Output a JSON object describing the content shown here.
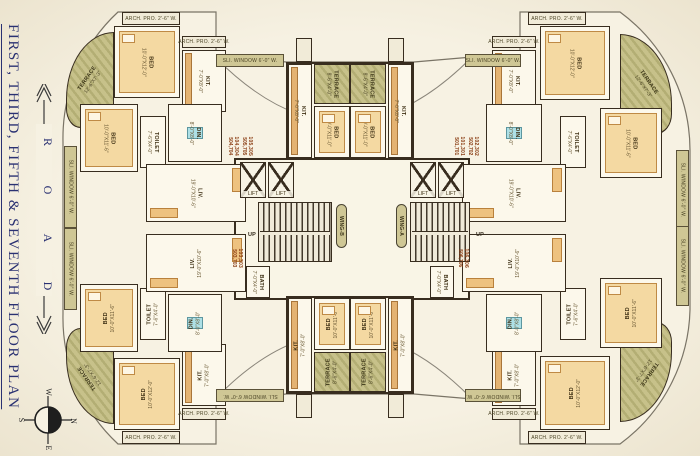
{
  "sidebar": {
    "title": "FIRST, THIRD, FIFTH & SEVENTH FLOOR PLAN",
    "road": {
      "letters": [
        "R",
        "O",
        "A",
        "D"
      ]
    },
    "compass": {
      "w": "W",
      "n": "N",
      "s": "S",
      "e": "E"
    }
  },
  "plan": {
    "accent_colors": {
      "wall": "#382d1f",
      "terrace": "#b3ae74",
      "window_strip": "#cfc795",
      "flat_number": "#8a3c12",
      "title_navy": "#2a3172"
    },
    "items": [
      {
        "n": "core-hall",
        "t": "core",
        "x": 234,
        "y": 158,
        "w": 236,
        "h": 142
      },
      {
        "n": "core-top-block",
        "t": "core",
        "x": 286,
        "y": 62,
        "w": 128,
        "h": 98
      },
      {
        "n": "core-bottom-block",
        "t": "core",
        "x": 286,
        "y": 296,
        "w": 128,
        "h": 98
      },
      {
        "n": "terrace-tl",
        "t": "terrace",
        "x": 66,
        "y": 32,
        "w": 48,
        "h": 96,
        "r": -55,
        "l": "TERRACE",
        "d": "12'-6\"X7'-3\"",
        "br": "100% 0 0 30% / 70% 0 0 20%"
      },
      {
        "n": "archpro-tl",
        "t": "box",
        "x": 122,
        "y": 12,
        "w": 58,
        "h": 13,
        "l": "ARCH. PRO. 2'-6\" W."
      },
      {
        "n": "bed1-tl",
        "t": "room",
        "x": 114,
        "y": 26,
        "w": 66,
        "h": 72,
        "r": 90,
        "l": "BED",
        "d": "10'-0\"X12'-0\"",
        "f": "bed"
      },
      {
        "n": "archpro2-tl",
        "t": "box",
        "x": 182,
        "y": 36,
        "w": 44,
        "h": 12,
        "l": "ARCH. PRO. 2'-6\" W."
      },
      {
        "n": "kit-tl",
        "t": "room",
        "x": 182,
        "y": 50,
        "w": 44,
        "h": 62,
        "r": 90,
        "l": "KIT.",
        "d": "7'-0\"X8'-0\"",
        "f": "counter"
      },
      {
        "n": "bed2-tl",
        "t": "room",
        "x": 80,
        "y": 104,
        "w": 58,
        "h": 68,
        "r": 90,
        "l": "BED",
        "d": "10'-0\"X11'-6\"",
        "f": "bed"
      },
      {
        "n": "sliwindow-tl",
        "t": "strip",
        "x": 64,
        "y": 146,
        "w": 13,
        "h": 82,
        "r": 90,
        "l": "SLI. WINDOW 6'-0\" W."
      },
      {
        "n": "toilet-tl",
        "t": "room",
        "x": 140,
        "y": 116,
        "w": 26,
        "h": 52,
        "r": 90,
        "l": "TOILET",
        "d": "7'-6\"X4'-0\""
      },
      {
        "n": "din-tl",
        "t": "room",
        "x": 168,
        "y": 104,
        "w": 54,
        "h": 58,
        "r": 90,
        "l": "DIN.",
        "d": "8'-0\"X8'-0\"",
        "f": "table"
      },
      {
        "n": "liv-tl",
        "t": "room",
        "x": 146,
        "y": 164,
        "w": 100,
        "h": 58,
        "r": 90,
        "l": "LIV.",
        "d": "19'-0\"X10'-6\"",
        "f": "sofa"
      },
      {
        "n": "terrace-bl",
        "t": "terrace",
        "x": 66,
        "y": 328,
        "w": 48,
        "h": 96,
        "r": 235,
        "l": "TERRACE",
        "d": "12'-6\"X7'-3\"",
        "br": "30% 0 0 100% / 20% 0 0 70%"
      },
      {
        "n": "archpro-bl",
        "t": "box",
        "x": 122,
        "y": 431,
        "w": 58,
        "h": 13,
        "l": "ARCH. PRO. 2'-6\" W."
      },
      {
        "n": "bed1-bl",
        "t": "room",
        "x": 114,
        "y": 358,
        "w": 66,
        "h": 72,
        "r": -90,
        "l": "BED",
        "d": "10'-0\"X12'-0\"",
        "f": "bed"
      },
      {
        "n": "archpro2-bl",
        "t": "box",
        "x": 182,
        "y": 408,
        "w": 44,
        "h": 12,
        "l": "ARCH. PRO. 2'-6\" W."
      },
      {
        "n": "kit-bl",
        "t": "room",
        "x": 182,
        "y": 344,
        "w": 44,
        "h": 62,
        "r": -90,
        "l": "KIT.",
        "d": "7'-0\"X8'-0\"",
        "f": "counter"
      },
      {
        "n": "bed2-bl",
        "t": "room",
        "x": 80,
        "y": 284,
        "w": 58,
        "h": 68,
        "r": -90,
        "l": "BED",
        "d": "10'-0\"X11'-6\"",
        "f": "bed"
      },
      {
        "n": "sliwindow-bl",
        "t": "strip",
        "x": 64,
        "y": 228,
        "w": 13,
        "h": 82,
        "r": 90,
        "l": "SLI. WINDOW 6'-0\" W."
      },
      {
        "n": "toilet-bl",
        "t": "room",
        "x": 140,
        "y": 288,
        "w": 26,
        "h": 52,
        "r": -90,
        "l": "TOILET",
        "d": "7'-6\"X4'-0\""
      },
      {
        "n": "din-bl",
        "t": "room",
        "x": 168,
        "y": 294,
        "w": 54,
        "h": 58,
        "r": -90,
        "l": "DIN.",
        "d": "8'-0\"X8'-0\"",
        "f": "table"
      },
      {
        "n": "liv-bl",
        "t": "room",
        "x": 146,
        "y": 234,
        "w": 100,
        "h": 58,
        "r": -90,
        "l": "LIV.",
        "d": "19'-0\"X10'-6\"",
        "f": "sofa"
      },
      {
        "n": "terrace-tr",
        "t": "terrace",
        "x": 620,
        "y": 34,
        "w": 52,
        "h": 100,
        "r": 55,
        "l": "TERRACE",
        "d": "12'-6\"X7'-3\"",
        "br": "0 100% 30% 0 / 0 70% 20% 0"
      },
      {
        "n": "archpro-tr",
        "t": "box",
        "x": 528,
        "y": 12,
        "w": 58,
        "h": 13,
        "l": "ARCH. PRO. 2'-6\" W."
      },
      {
        "n": "bed1-tr",
        "t": "room",
        "x": 540,
        "y": 26,
        "w": 70,
        "h": 74,
        "r": 90,
        "l": "BED",
        "d": "10'-0\"X12'-0\"",
        "f": "bed"
      },
      {
        "n": "archpro2-tr",
        "t": "box",
        "x": 492,
        "y": 36,
        "w": 44,
        "h": 12,
        "l": "ARCH. PRO. 2'-6\" W."
      },
      {
        "n": "kit-tr",
        "t": "room",
        "x": 492,
        "y": 50,
        "w": 44,
        "h": 62,
        "r": 90,
        "l": "KIT.",
        "d": "7'-0\"X8'-0\"",
        "f": "counter"
      },
      {
        "n": "bed2-tr",
        "t": "room",
        "x": 600,
        "y": 108,
        "w": 62,
        "h": 70,
        "r": 90,
        "l": "BED",
        "d": "10'-0\"X11'-6\"",
        "f": "bed"
      },
      {
        "n": "sliwindow-tr",
        "t": "strip",
        "x": 676,
        "y": 150,
        "w": 13,
        "h": 80,
        "r": 90,
        "l": "SLI. WINDOW 6'-0\" W."
      },
      {
        "n": "toilet-tr",
        "t": "room",
        "x": 560,
        "y": 116,
        "w": 26,
        "h": 52,
        "r": 90,
        "l": "TOILET",
        "d": "7'-6\"X4'-0\""
      },
      {
        "n": "din-tr",
        "t": "room",
        "x": 486,
        "y": 104,
        "w": 56,
        "h": 58,
        "r": 90,
        "l": "DIN.",
        "d": "8'-0\"X8'-0\"",
        "f": "table"
      },
      {
        "n": "liv-tr",
        "t": "room",
        "x": 462,
        "y": 164,
        "w": 104,
        "h": 58,
        "r": 90,
        "l": "LIV.",
        "d": "19'-0\"X10'-6\"",
        "f": "sofa"
      },
      {
        "n": "terrace-br",
        "t": "terrace",
        "x": 620,
        "y": 322,
        "w": 52,
        "h": 100,
        "r": 125,
        "l": "TERRACE",
        "d": "12'-6\"X7'-3\"",
        "br": "0 30% 100% 0 / 0 20% 70% 0"
      },
      {
        "n": "archpro-br",
        "t": "box",
        "x": 528,
        "y": 431,
        "w": 58,
        "h": 13,
        "l": "ARCH. PRO. 2'-6\" W."
      },
      {
        "n": "bed1-br",
        "t": "room",
        "x": 540,
        "y": 356,
        "w": 70,
        "h": 74,
        "r": -90,
        "l": "BED",
        "d": "10'-0\"X12'-0\"",
        "f": "bed"
      },
      {
        "n": "archpro2-br",
        "t": "box",
        "x": 492,
        "y": 408,
        "w": 44,
        "h": 12,
        "l": "ARCH. PRO. 2'-6\" W."
      },
      {
        "n": "kit-br",
        "t": "room",
        "x": 492,
        "y": 344,
        "w": 44,
        "h": 62,
        "r": -90,
        "l": "KIT.",
        "d": "7'-0\"X8'-0\"",
        "f": "counter"
      },
      {
        "n": "bed2-br",
        "t": "room",
        "x": 600,
        "y": 278,
        "w": 62,
        "h": 70,
        "r": -90,
        "l": "BED",
        "d": "10'-0\"X11'-6\"",
        "f": "bed"
      },
      {
        "n": "sliwindow-br",
        "t": "strip",
        "x": 676,
        "y": 226,
        "w": 13,
        "h": 80,
        "r": 90,
        "l": "SLI. WINDOW 6'-0\" W."
      },
      {
        "n": "toilet-br",
        "t": "room",
        "x": 560,
        "y": 288,
        "w": 26,
        "h": 52,
        "r": -90,
        "l": "TOILET",
        "d": "7'-6\"X4'-0\""
      },
      {
        "n": "din-br",
        "t": "room",
        "x": 486,
        "y": 294,
        "w": 56,
        "h": 58,
        "r": -90,
        "l": "DIN.",
        "d": "8'-0\"X8'-0\"",
        "f": "table"
      },
      {
        "n": "liv-br",
        "t": "room",
        "x": 462,
        "y": 234,
        "w": 104,
        "h": 58,
        "r": -90,
        "l": "LIV.",
        "d": "19'-0\"X10'-6\"",
        "f": "sofa"
      },
      {
        "n": "kit-center-top-left",
        "t": "room",
        "x": 288,
        "y": 64,
        "w": 24,
        "h": 94,
        "r": 90,
        "l": "KIT.",
        "d": "7'-0\"X8'-0\"",
        "f": "counter"
      },
      {
        "n": "kit-center-top-right",
        "t": "room",
        "x": 388,
        "y": 64,
        "w": 24,
        "h": 94,
        "r": 90,
        "l": "KIT.",
        "d": "7'-0\"X8'-0\"",
        "f": "counter"
      },
      {
        "n": "terrace-center-top-left",
        "t": "terrace",
        "x": 314,
        "y": 64,
        "w": 36,
        "h": 40,
        "r": 90,
        "l": "TERRACE",
        "d": "8'-6\"X4'-0\""
      },
      {
        "n": "terrace-center-top-right",
        "t": "terrace",
        "x": 350,
        "y": 64,
        "w": 36,
        "h": 40,
        "r": 90,
        "l": "TERRACE",
        "d": "8'-6\"X4'-0\""
      },
      {
        "n": "bed-center-top-left",
        "t": "room",
        "x": 314,
        "y": 106,
        "w": 36,
        "h": 52,
        "r": 90,
        "l": "BED",
        "d": "10'-0\"X11'-0\"",
        "f": "bed"
      },
      {
        "n": "bed-center-top-right",
        "t": "room",
        "x": 350,
        "y": 106,
        "w": 36,
        "h": 52,
        "r": 90,
        "l": "BED",
        "d": "10'-0\"X11'-0\"",
        "f": "bed"
      },
      {
        "n": "duct-top-left",
        "t": "box",
        "x": 296,
        "y": 38,
        "w": 16,
        "h": 24
      },
      {
        "n": "duct-top-right",
        "t": "box",
        "x": 388,
        "y": 38,
        "w": 16,
        "h": 24
      },
      {
        "n": "kit-center-bottom-left",
        "t": "room",
        "x": 288,
        "y": 298,
        "w": 24,
        "h": 94,
        "r": -90,
        "l": "KIT.",
        "d": "7'-0\"X8'-0\"",
        "f": "counter"
      },
      {
        "n": "kit-center-bottom-right",
        "t": "room",
        "x": 388,
        "y": 298,
        "w": 24,
        "h": 94,
        "r": -90,
        "l": "KIT.",
        "d": "7'-0\"X8'-0\"",
        "f": "counter"
      },
      {
        "n": "bed-center-bottom-left",
        "t": "room",
        "x": 314,
        "y": 298,
        "w": 36,
        "h": 52,
        "r": -90,
        "l": "BED",
        "d": "10'-0\"X11'-0\"",
        "f": "bed"
      },
      {
        "n": "bed-center-bottom-right",
        "t": "room",
        "x": 350,
        "y": 298,
        "w": 36,
        "h": 52,
        "r": -90,
        "l": "BED",
        "d": "10'-0\"X11'-0\"",
        "f": "bed"
      },
      {
        "n": "terrace-center-bottom-left",
        "t": "terrace",
        "x": 314,
        "y": 352,
        "w": 36,
        "h": 40,
        "r": -90,
        "l": "TERRACE",
        "d": "8'-6\"X4'-0\""
      },
      {
        "n": "terrace-center-bottom-right",
        "t": "terrace",
        "x": 350,
        "y": 352,
        "w": 36,
        "h": 40,
        "r": -90,
        "l": "TERRACE",
        "d": "8'-6\"X4'-0\""
      },
      {
        "n": "duct-bottom-left",
        "t": "box",
        "x": 296,
        "y": 394,
        "w": 16,
        "h": 24
      },
      {
        "n": "duct-bottom-right",
        "t": "box",
        "x": 388,
        "y": 394,
        "w": 16,
        "h": 24
      },
      {
        "n": "sliwindow-band-top-left",
        "t": "strip",
        "x": 216,
        "y": 54,
        "w": 68,
        "h": 13,
        "l": "SLI. WINDOW 6'-0\" W."
      },
      {
        "n": "sliwindow-band-top-right",
        "t": "strip",
        "x": 465,
        "y": 54,
        "w": 56,
        "h": 13,
        "l": "SLI. WINDOW 6'-0\" W."
      },
      {
        "n": "sliwindow-band-bottom-left",
        "t": "strip",
        "x": 216,
        "y": 389,
        "w": 68,
        "h": 13,
        "r": 180,
        "l": "SLI. WINDOW 6'-0\" W."
      },
      {
        "n": "sliwindow-band-bottom-right",
        "t": "strip",
        "x": 465,
        "y": 389,
        "w": 56,
        "h": 13,
        "r": 180,
        "l": "SLI. WINDOW 6'-0\" W."
      },
      {
        "n": "lift-left-1",
        "t": "lift",
        "x": 240,
        "y": 162,
        "w": 26,
        "h": 36,
        "l": "LIFT"
      },
      {
        "n": "lift-left-2",
        "t": "lift",
        "x": 268,
        "y": 162,
        "w": 26,
        "h": 36,
        "l": "LIFT"
      },
      {
        "n": "lift-right-1",
        "t": "lift",
        "x": 410,
        "y": 162,
        "w": 26,
        "h": 36,
        "l": "LIFT"
      },
      {
        "n": "lift-right-2",
        "t": "lift",
        "x": 438,
        "y": 162,
        "w": 26,
        "h": 36,
        "l": "LIFT"
      },
      {
        "n": "staircase-left",
        "t": "stair",
        "x": 258,
        "y": 202,
        "w": 74,
        "h": 60
      },
      {
        "n": "staircase-right",
        "t": "stair",
        "x": 410,
        "y": 202,
        "w": 60,
        "h": 60
      },
      {
        "n": "bath-left",
        "t": "room",
        "x": 246,
        "y": 266,
        "w": 24,
        "h": 32,
        "r": 90,
        "l": "BATH",
        "d": "7'-0\"X4'-0\""
      },
      {
        "n": "bath-right",
        "t": "room",
        "x": 430,
        "y": 266,
        "w": 24,
        "h": 32,
        "r": 90,
        "l": "BATH",
        "d": "7'-0\"X4'-0\""
      },
      {
        "n": "wing-b-label",
        "t": "pill",
        "x": 336,
        "y": 204,
        "w": 11,
        "h": 44,
        "r": 90,
        "l": "WING-B"
      },
      {
        "n": "wing-a-label",
        "t": "pill",
        "x": 396,
        "y": 204,
        "w": 11,
        "h": 44,
        "r": 90,
        "l": "WING-A"
      },
      {
        "n": "up-label-left",
        "t": "small",
        "x": 244,
        "y": 230,
        "w": 16,
        "h": 10,
        "l": "UP"
      },
      {
        "n": "up-label-right",
        "t": "small",
        "x": 472,
        "y": 230,
        "w": 16,
        "h": 10,
        "l": "UP"
      },
      {
        "n": "flat-number-104",
        "t": "num",
        "x": 226,
        "y": 124,
        "w": 14,
        "h": 44,
        "r": 90,
        "l": "104,304",
        "d": "504,704"
      },
      {
        "n": "flat-number-105",
        "t": "num",
        "x": 240,
        "y": 124,
        "w": 14,
        "h": 44,
        "r": 90,
        "l": "105,305",
        "d": "505,705"
      },
      {
        "n": "flat-number-103",
        "t": "num",
        "x": 230,
        "y": 236,
        "w": 14,
        "h": 44,
        "r": 90,
        "l": "103,303",
        "d": "503,703"
      },
      {
        "n": "flat-number-101",
        "t": "num",
        "x": 452,
        "y": 124,
        "w": 14,
        "h": 44,
        "r": 90,
        "l": "101,301",
        "d": "501,701"
      },
      {
        "n": "flat-number-102",
        "t": "num",
        "x": 466,
        "y": 124,
        "w": 14,
        "h": 44,
        "r": 90,
        "l": "102,302",
        "d": "502,702"
      },
      {
        "n": "flat-number-106",
        "t": "num",
        "x": 456,
        "y": 236,
        "w": 14,
        "h": 44,
        "r": 90,
        "l": "106,306",
        "d": "506,706"
      }
    ]
  }
}
